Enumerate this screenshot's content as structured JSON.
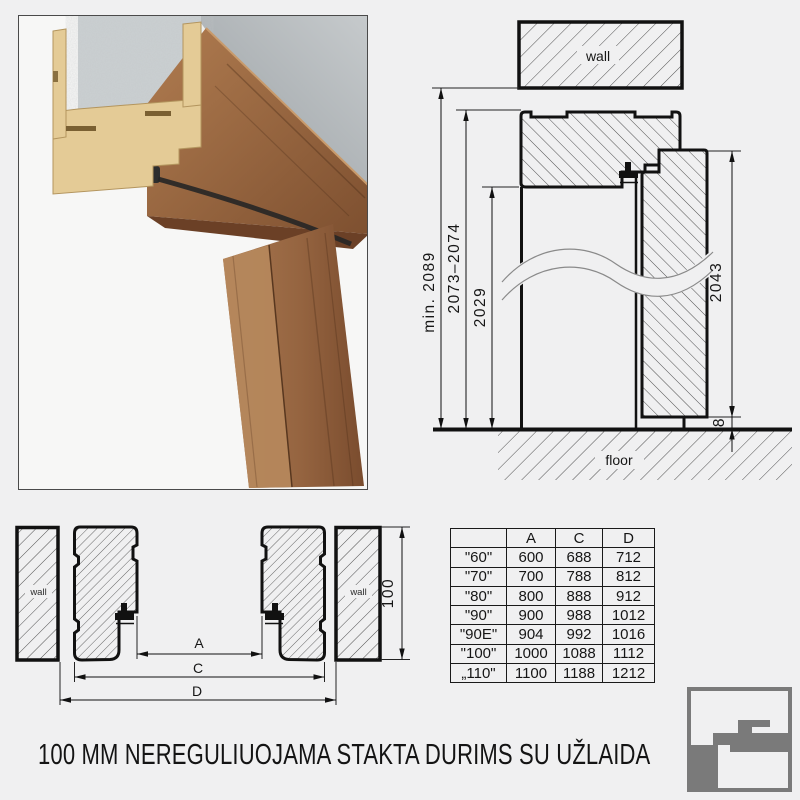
{
  "page_title": "100 MM NEREGULIUOJAMA STAKTA DURIMS SU UŽLAIDA",
  "vertical_section": {
    "wall_label": "wall",
    "floor_label": "floor",
    "min_total_height": "min. 2089",
    "frame_height_range": "2073–2074",
    "clear_opening_height": "2029",
    "door_leaf_height": "2043",
    "floor_gap": "8"
  },
  "horizontal_section": {
    "left_wall_label": "wall",
    "right_wall_label": "wall",
    "opening_width_label": "A",
    "frame_outer_width_label": "C",
    "overall_width_label": "D",
    "frame_depth": "100"
  },
  "size_table": {
    "headers": [
      "",
      "A",
      "C",
      "D"
    ],
    "rows": [
      [
        "\"60\"",
        "600",
        "688",
        "712"
      ],
      [
        "\"70\"",
        "700",
        "788",
        "812"
      ],
      [
        "\"80\"",
        "800",
        "888",
        "912"
      ],
      [
        "\"90\"",
        "900",
        "988",
        "1012"
      ],
      [
        "\"90E\"",
        "904",
        "992",
        "1016"
      ],
      [
        "\"100\"",
        "1000",
        "1088",
        "1112"
      ],
      [
        "„110\"",
        "1100",
        "1188",
        "1212"
      ]
    ]
  },
  "colors": {
    "line": "#1a1a1a",
    "background": "#f0f0f1",
    "logo_gray": "#7a7a7a",
    "wood": "#9a6a45",
    "mdf": "#e3cb97",
    "concrete": "#b4b9bc"
  }
}
